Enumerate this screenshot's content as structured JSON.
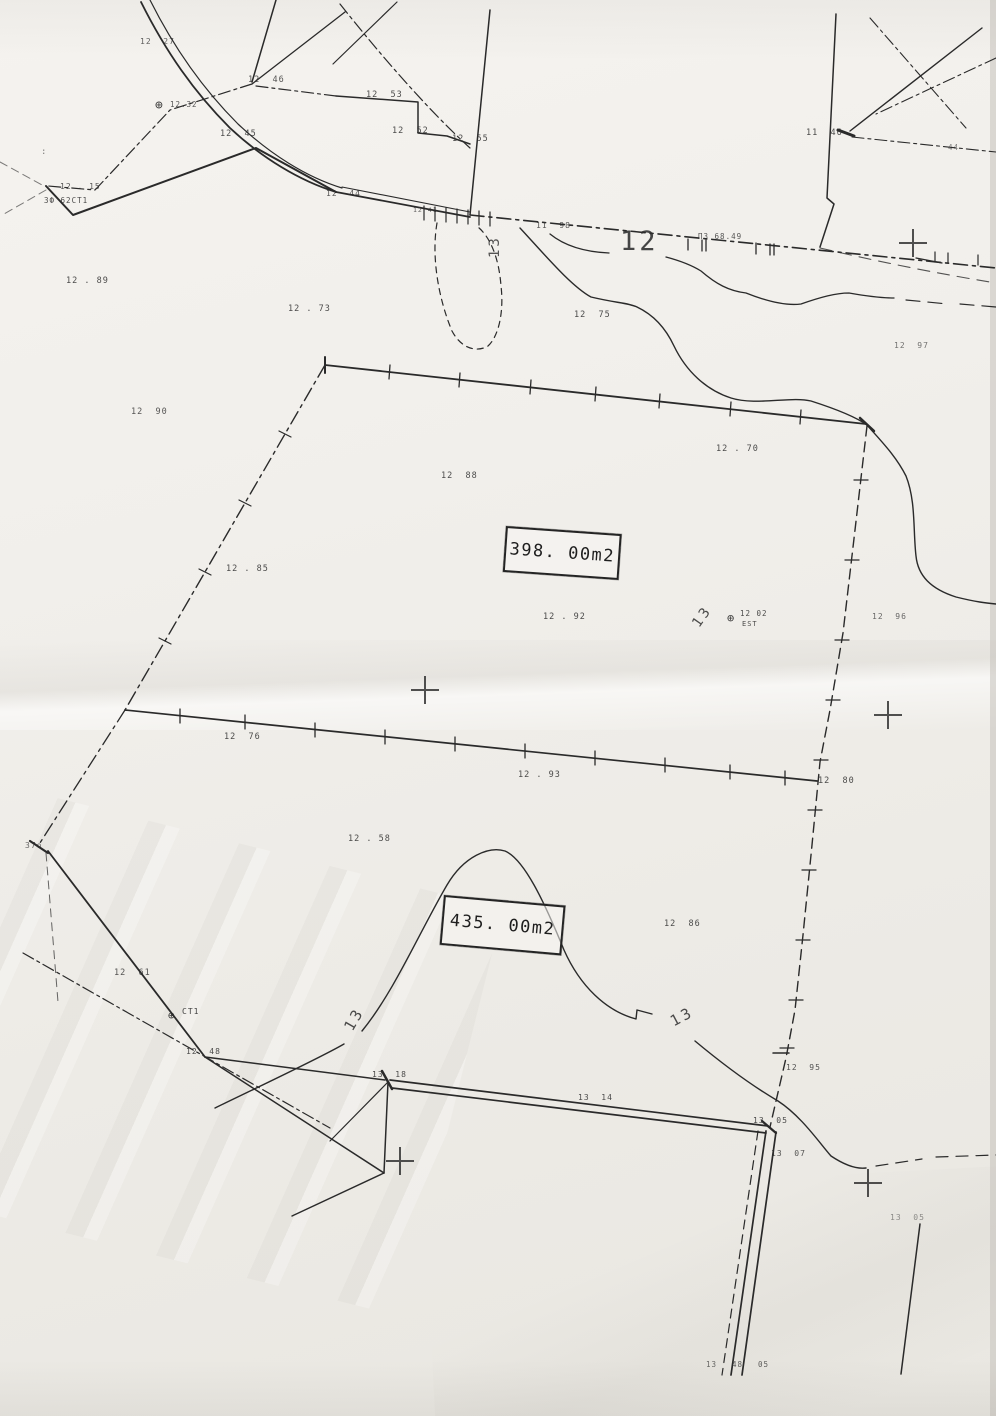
{
  "map": {
    "description_labels": {
      "upper_area_value": "398. 00m2",
      "lower_area_value": "435. 00m2"
    },
    "area_boxes": [
      {
        "text": "398. 00m2",
        "x": 506,
        "y": 526,
        "w": 112,
        "h": 42,
        "rot": 4
      },
      {
        "text": "435. 00m2",
        "x": 444,
        "y": 895,
        "w": 118,
        "h": 46,
        "rot": 5
      }
    ],
    "labels": [
      {
        "t": "12  27",
        "x": 140,
        "y": 38,
        "s": 8,
        "o": 0.75
      },
      {
        "t": "12  46",
        "x": 248,
        "y": 76,
        "s": 8.5,
        "o": 0.8
      },
      {
        "t": "12  53",
        "x": 366,
        "y": 91,
        "s": 8.5,
        "o": 0.85
      },
      {
        "t": "12  52",
        "x": 392,
        "y": 127,
        "s": 8.5,
        "o": 0.85
      },
      {
        "t": "12  55",
        "x": 452,
        "y": 135,
        "s": 8.5,
        "o": 0.85
      },
      {
        "t": "⊕",
        "x": 155,
        "y": 99,
        "s": 13,
        "o": 0.9
      },
      {
        "t": "12.32",
        "x": 170,
        "y": 101,
        "s": 7.5,
        "o": 0.8
      },
      {
        "t": "12  45",
        "x": 220,
        "y": 130,
        "s": 8.5,
        "o": 0.85
      },
      {
        "t": "12 . 15",
        "x": 60,
        "y": 183,
        "s": 8,
        "o": 0.8
      },
      {
        "t": "3Ф 62CT1",
        "x": 44,
        "y": 197,
        "s": 7.5,
        "o": 0.85
      },
      {
        "t": ":",
        "x": 41,
        "y": 148,
        "s": 9,
        "o": 0.6
      },
      {
        "t": "12  44",
        "x": 326,
        "y": 190,
        "s": 8,
        "o": 0.8
      },
      {
        "t": "12 41",
        "x": 413,
        "y": 207,
        "s": 6.5,
        "o": 0.75
      },
      {
        "t": "11  98",
        "x": 536,
        "y": 222,
        "s": 8,
        "o": 0.8
      },
      {
        "t": "12",
        "x": 620,
        "y": 228,
        "s": 27,
        "o": 0.88,
        "big": true
      },
      {
        "t": "11  46",
        "x": 806,
        "y": 129,
        "s": 8.5,
        "o": 0.85
      },
      {
        "t": "44",
        "x": 948,
        "y": 144,
        "s": 7.5,
        "o": 0.6
      },
      {
        "t": "ПЗ 68.49",
        "x": 698,
        "y": 233,
        "s": 7.5,
        "o": 0.8
      },
      {
        "t": "12  97",
        "x": 894,
        "y": 342,
        "s": 8,
        "o": 0.65
      },
      {
        "t": "12 . 89",
        "x": 66,
        "y": 277,
        "s": 8.5,
        "o": 0.85
      },
      {
        "t": "12 . 73",
        "x": 288,
        "y": 305,
        "s": 8.5,
        "o": 0.85
      },
      {
        "t": "12  75",
        "x": 574,
        "y": 311,
        "s": 8.5,
        "o": 0.85
      },
      {
        "t": "13",
        "x": 488,
        "y": 258,
        "s": 14,
        "r": -90,
        "o": 0.8,
        "big": true
      },
      {
        "t": "12  90",
        "x": 131,
        "y": 408,
        "s": 8.5,
        "o": 0.8
      },
      {
        "t": "12 . 70",
        "x": 716,
        "y": 445,
        "s": 8.5,
        "o": 0.85
      },
      {
        "t": "12  88",
        "x": 441,
        "y": 472,
        "s": 8.5,
        "o": 0.85
      },
      {
        "t": "12 . 85",
        "x": 226,
        "y": 565,
        "s": 8.5,
        "o": 0.85
      },
      {
        "t": "12 . 92",
        "x": 543,
        "y": 613,
        "s": 8.5,
        "o": 0.85
      },
      {
        "t": "13",
        "x": 690,
        "y": 622,
        "s": 14,
        "r": -55,
        "o": 0.85,
        "big": true
      },
      {
        "t": "⊕",
        "x": 727,
        "y": 612,
        "s": 12,
        "o": 0.9
      },
      {
        "t": "12 02",
        "x": 740,
        "y": 610,
        "s": 7.5,
        "o": 0.85
      },
      {
        "t": "EST",
        "x": 742,
        "y": 621,
        "s": 7,
        "o": 0.85
      },
      {
        "t": "12  96",
        "x": 872,
        "y": 613,
        "s": 8,
        "o": 0.7
      },
      {
        "t": "12  76",
        "x": 224,
        "y": 733,
        "s": 8.5,
        "o": 0.85
      },
      {
        "t": "12 . 93",
        "x": 518,
        "y": 771,
        "s": 8.5,
        "o": 0.85
      },
      {
        "t": "12  80",
        "x": 818,
        "y": 777,
        "s": 8.5,
        "o": 0.85
      },
      {
        "t": "12 . 58",
        "x": 348,
        "y": 835,
        "s": 8.5,
        "o": 0.85
      },
      {
        "t": "12  86",
        "x": 664,
        "y": 920,
        "s": 8.5,
        "o": 0.85
      },
      {
        "t": "13",
        "x": 342,
        "y": 1026,
        "s": 15,
        "r": -60,
        "o": 0.85,
        "big": true
      },
      {
        "t": "13",
        "x": 668,
        "y": 1016,
        "s": 15,
        "r": -28,
        "o": 0.85,
        "big": true
      },
      {
        "t": "37o",
        "x": 25,
        "y": 842,
        "s": 8,
        "o": 0.7
      },
      {
        "t": "12  61",
        "x": 114,
        "y": 969,
        "s": 8.5,
        "o": 0.8
      },
      {
        "t": "⊕",
        "x": 168,
        "y": 1010,
        "s": 11,
        "o": 0.95
      },
      {
        "t": "CT1",
        "x": 182,
        "y": 1008,
        "s": 8,
        "o": 0.9
      },
      {
        "t": "12  48",
        "x": 186,
        "y": 1048,
        "s": 8,
        "o": 0.85
      },
      {
        "t": "13  18",
        "x": 372,
        "y": 1071,
        "s": 8,
        "o": 0.85
      },
      {
        "t": "13  14",
        "x": 578,
        "y": 1094,
        "s": 8,
        "o": 0.85
      },
      {
        "t": "13  05",
        "x": 753,
        "y": 1117,
        "s": 8,
        "o": 0.85
      },
      {
        "t": "12  95",
        "x": 786,
        "y": 1064,
        "s": 8,
        "o": 0.8
      },
      {
        "t": "13  07",
        "x": 771,
        "y": 1150,
        "s": 8,
        "o": 0.8
      },
      {
        "t": "13  05",
        "x": 890,
        "y": 1214,
        "s": 8,
        "o": 0.5
      },
      {
        "t": "13",
        "x": 706,
        "y": 1361,
        "s": 7.5,
        "o": 0.7
      },
      {
        "t": "48",
        "x": 732,
        "y": 1361,
        "s": 7.5,
        "o": 0.75
      },
      {
        "t": "05",
        "x": 758,
        "y": 1361,
        "s": 7.5,
        "o": 0.75
      }
    ],
    "crosses": [
      {
        "x": 913,
        "y": 243
      },
      {
        "x": 425,
        "y": 690
      },
      {
        "x": 888,
        "y": 715
      },
      {
        "x": 400,
        "y": 1161
      },
      {
        "x": 868,
        "y": 1183
      }
    ],
    "ink_color": "#2a2a2a",
    "paper_color": "#f1efeb"
  }
}
